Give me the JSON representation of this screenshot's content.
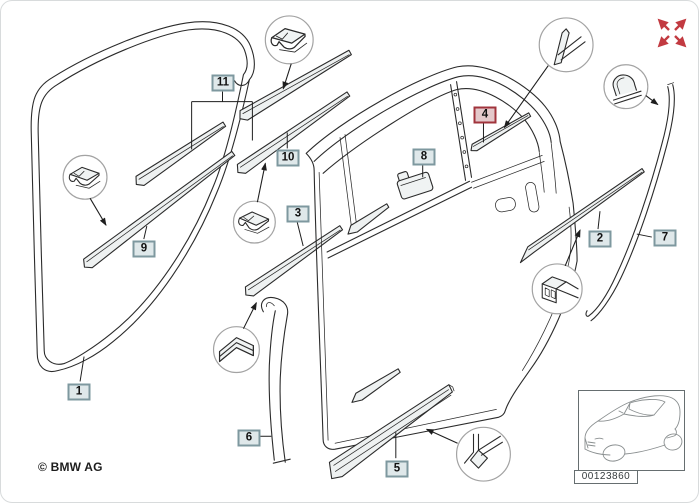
{
  "callouts": [
    {
      "number": "1",
      "highlighted": false
    },
    {
      "number": "2",
      "highlighted": false
    },
    {
      "number": "3",
      "highlighted": false
    },
    {
      "number": "4",
      "highlighted": true
    },
    {
      "number": "5",
      "highlighted": false
    },
    {
      "number": "6",
      "highlighted": false
    },
    {
      "number": "7",
      "highlighted": false
    },
    {
      "number": "8",
      "highlighted": false
    },
    {
      "number": "9",
      "highlighted": false
    },
    {
      "number": "10",
      "highlighted": false
    },
    {
      "number": "11",
      "highlighted": false
    }
  ],
  "footer": {
    "copyright": "© BMW AG"
  },
  "thumbnail": {
    "image_number": "00123860"
  },
  "icons": {
    "expand": "fullscreen-expand-icon"
  },
  "colors": {
    "callout_border": "#7E989F",
    "callout_fill": "#DFE8EA",
    "highlight_border": "#A1343C",
    "highlight_fill": "#E4C9CB",
    "line": "#2B2B2B",
    "accent_red": "#C23A41"
  }
}
